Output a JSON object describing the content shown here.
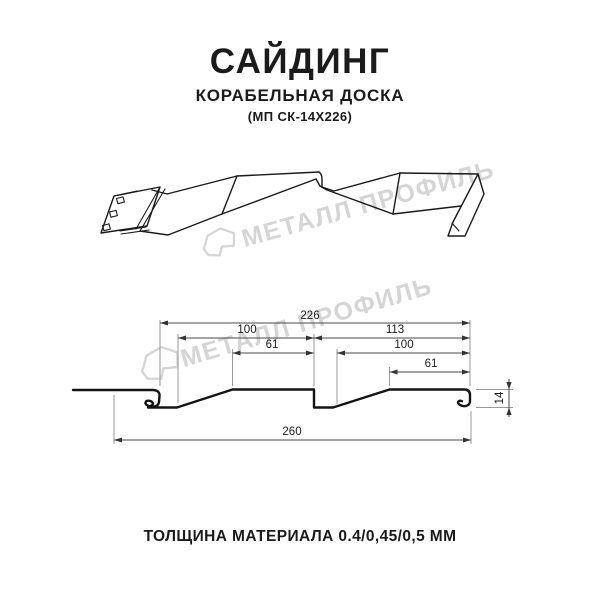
{
  "header": {
    "title": "САЙДИНГ",
    "subtitle": "КОРАБЕЛЬНАЯ ДОСКА",
    "code": "(МП СК-14Х226)"
  },
  "watermark": {
    "brand": "МЕТАЛЛ ПРОФИЛЬ",
    "color": "#d5d5d5"
  },
  "drawing": {
    "line_color": "#1a1a1a",
    "dimension_line_color": "#555555"
  },
  "dimensions": {
    "total_width": "226",
    "left_pitch": "100",
    "left_flat": "61",
    "right_pitch": "113",
    "right_mid": "100",
    "right_flat": "61",
    "profile_height": "14",
    "overall_width": "260"
  },
  "footer": {
    "thickness_note": "ТОЛЩИНА МАТЕРИАЛА 0.4/0,45/0,5 ММ"
  }
}
